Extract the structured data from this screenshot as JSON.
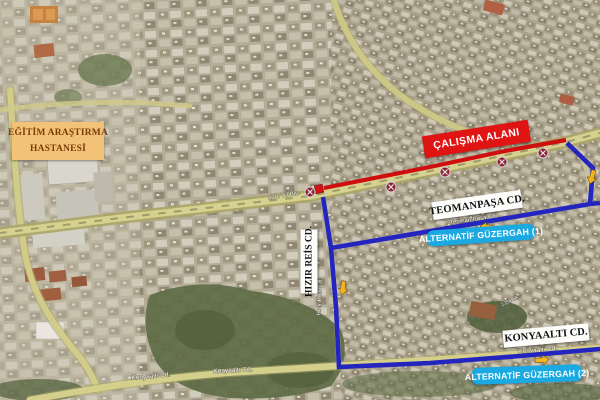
{
  "map": {
    "description": "Satellite detour map: road work zone with two alternative routes",
    "labels": {
      "hospital": {
        "line1": "EĞİTİM ARAŞTIRMA",
        "line2": "HASTANESİ"
      },
      "work_area": "ÇALIŞMA ALANI",
      "teomanpasa": "TEOMANPAŞA CD.",
      "hizir_reis": "HIZIR REİS CD.",
      "konyaalti": "KONYAALTI CD.",
      "alt_route_1": "ALTERNATİF GÜZERGAH (1)",
      "alt_route_2": "ALTERNATİF GÜZERGAH (2)"
    },
    "street_names": {
      "main_blvd": "100. Yıl Blv.",
      "teoman_pasa": "Teoman Paşa Cd",
      "hizir_reis": "Hızır Reis Cd.",
      "konyaalti_west": "Konyaaltı Cd.",
      "konyaalti_mid": "Konyaaltı Cd.",
      "konyaalti_east": "Konyaaltı Cd.",
      "side_street": "1354 Sk."
    },
    "colors": {
      "closure_line": "#cf0f0f",
      "detour_line": "#2424be",
      "direction_arrow": "#f3b31e",
      "work_label_bg": "#e11414",
      "alt_label_bg": "#1aa9e0",
      "hospital_label_bg": "#f2c376",
      "hospital_label_fg": "#7a3c0a",
      "road_fill": "#d7d18f"
    },
    "annotations": {
      "no_stopping_sign_count": 5,
      "closure_start_marker_count": 1,
      "direction_arrow_count": 4
    }
  }
}
